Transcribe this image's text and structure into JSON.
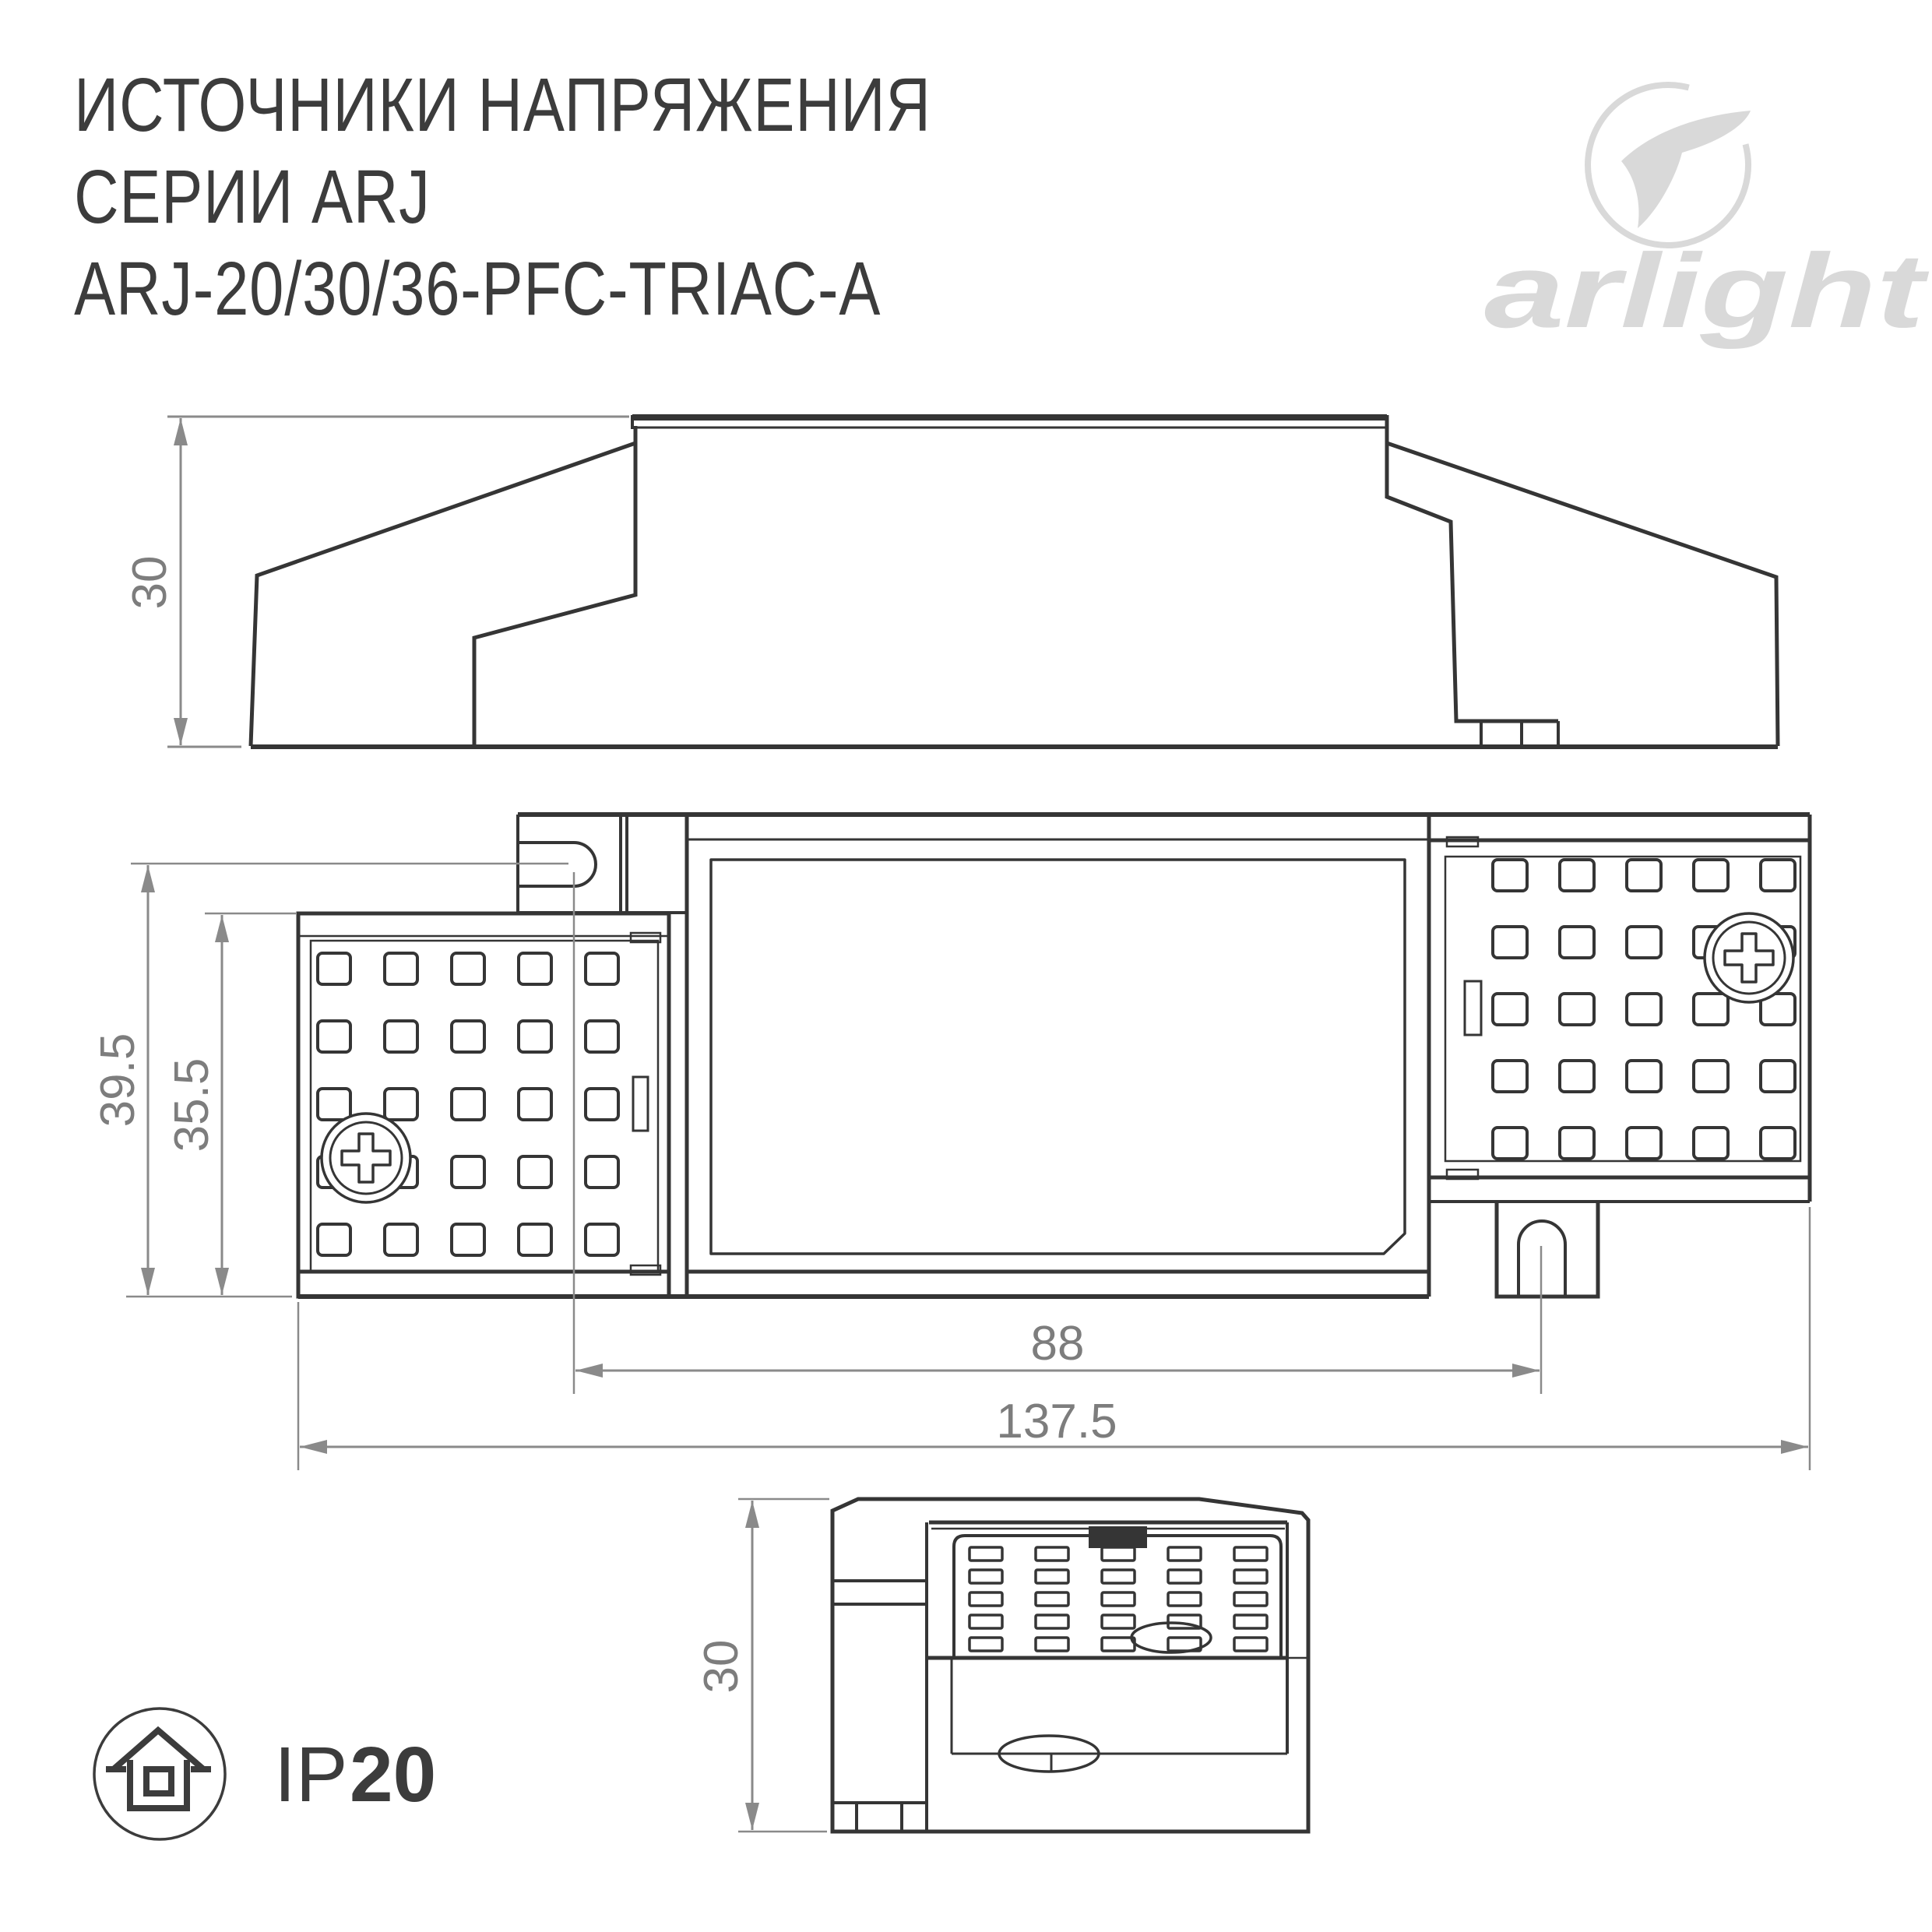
{
  "title": {
    "line1": "ИСТОЧНИКИ НАПРЯЖЕНИЯ",
    "line2": "СЕРИИ ARJ",
    "line3": "ARJ-20/30/36-PFC-TRIAC-A"
  },
  "logo": {
    "brand": "arlight"
  },
  "dimensions": {
    "side_height": "30",
    "plan_overall_height": "39.5",
    "plan_body_height": "35.5",
    "mount_hole_spacing": "88",
    "overall_length": "137.5",
    "end_height": "30"
  },
  "ip_rating": {
    "prefix": "IP",
    "value": "20"
  },
  "colors": {
    "line": "#353535",
    "dimension": "#8a8a8a",
    "dimension_text": "#7d7d7d",
    "logo": "#d9d9d9",
    "background": "#ffffff"
  }
}
